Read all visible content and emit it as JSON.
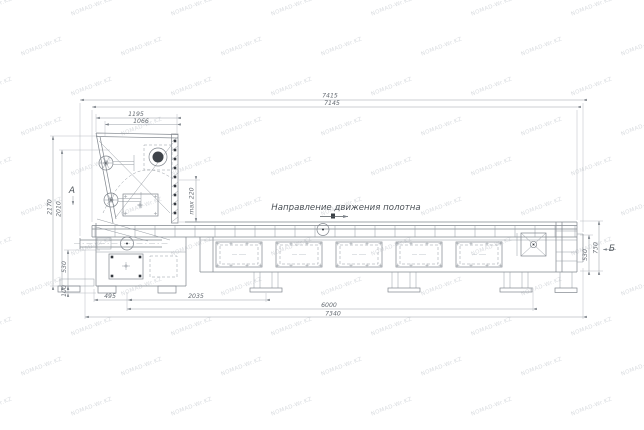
{
  "watermark": {
    "text": "NOMAD-Wr.KZ"
  },
  "drawing": {
    "direction_note": "Направление движения полотна",
    "sections": {
      "left": "А",
      "right": "Б"
    },
    "dims": {
      "overall_width_top": "7415",
      "inner_width_top": "7145",
      "hopper_width_outer": "1195",
      "hopper_width_inner": "1066",
      "height_outer": "2170",
      "height_inner": "2010",
      "max_note": "max 220",
      "belt_height_left": "530",
      "foot_height_left": "100",
      "offset_first": "495",
      "offset_second": "2035",
      "frame_length": "6000",
      "overall_length": "7340",
      "right_height_inner": "530",
      "right_height_outer": "730"
    }
  }
}
